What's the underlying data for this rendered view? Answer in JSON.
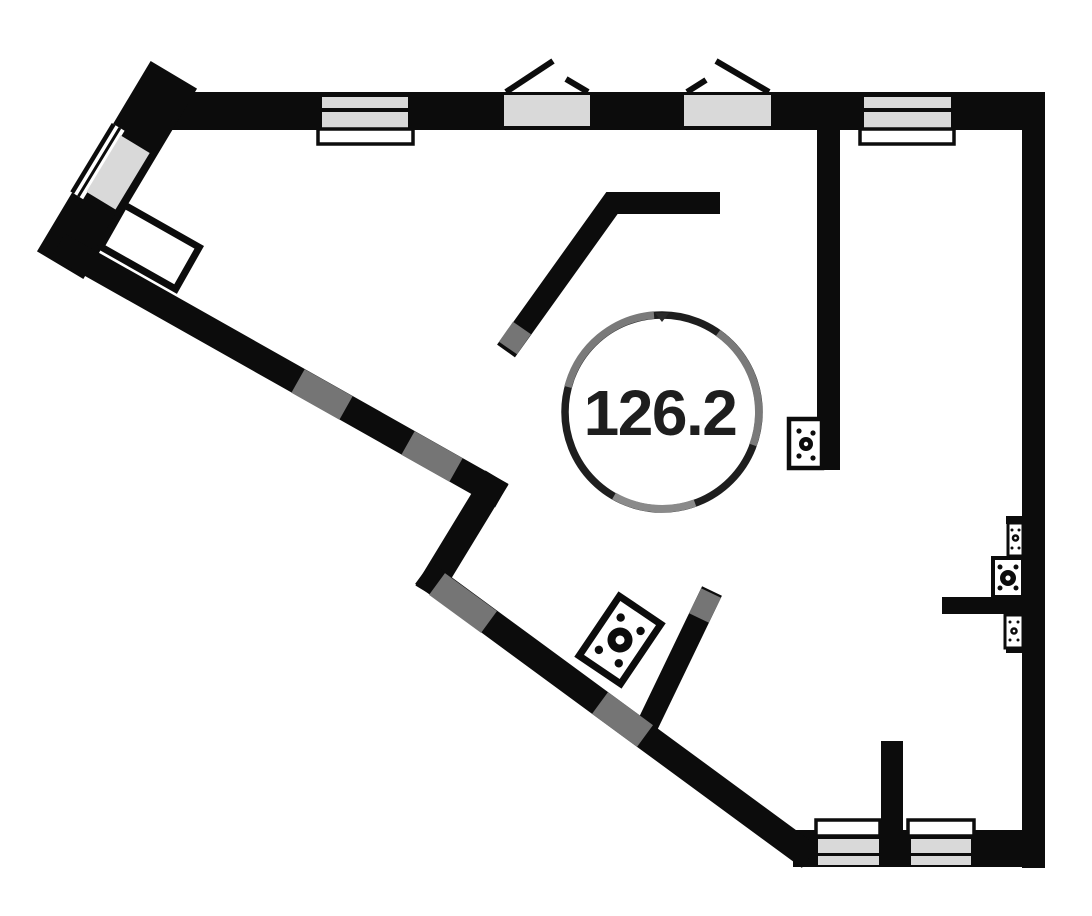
{
  "document": {
    "type": "apartment-floor-plan-drawing"
  },
  "area_label": {
    "value": "126.2"
  },
  "colors": {
    "background": "#ffffff",
    "wall": "#0c0c0c",
    "window_fill": "#d9d9d9",
    "watermark_gray": "#757575",
    "circle_stroke": "#1e1e1e",
    "label_text": "#1e1e1e"
  },
  "components": {
    "top_windows": [
      "banded-window",
      "casement-window-open-sash",
      "casement-window-open-sash",
      "banded-window"
    ],
    "bottom_windows": [
      "banded-window",
      "banded-window"
    ],
    "side_window": "angled-wall-window",
    "utility_symbols": [
      "junction-box",
      "junction-box-rotated",
      "junction-box-small",
      "junction-box-medium",
      "junction-box-small"
    ]
  }
}
